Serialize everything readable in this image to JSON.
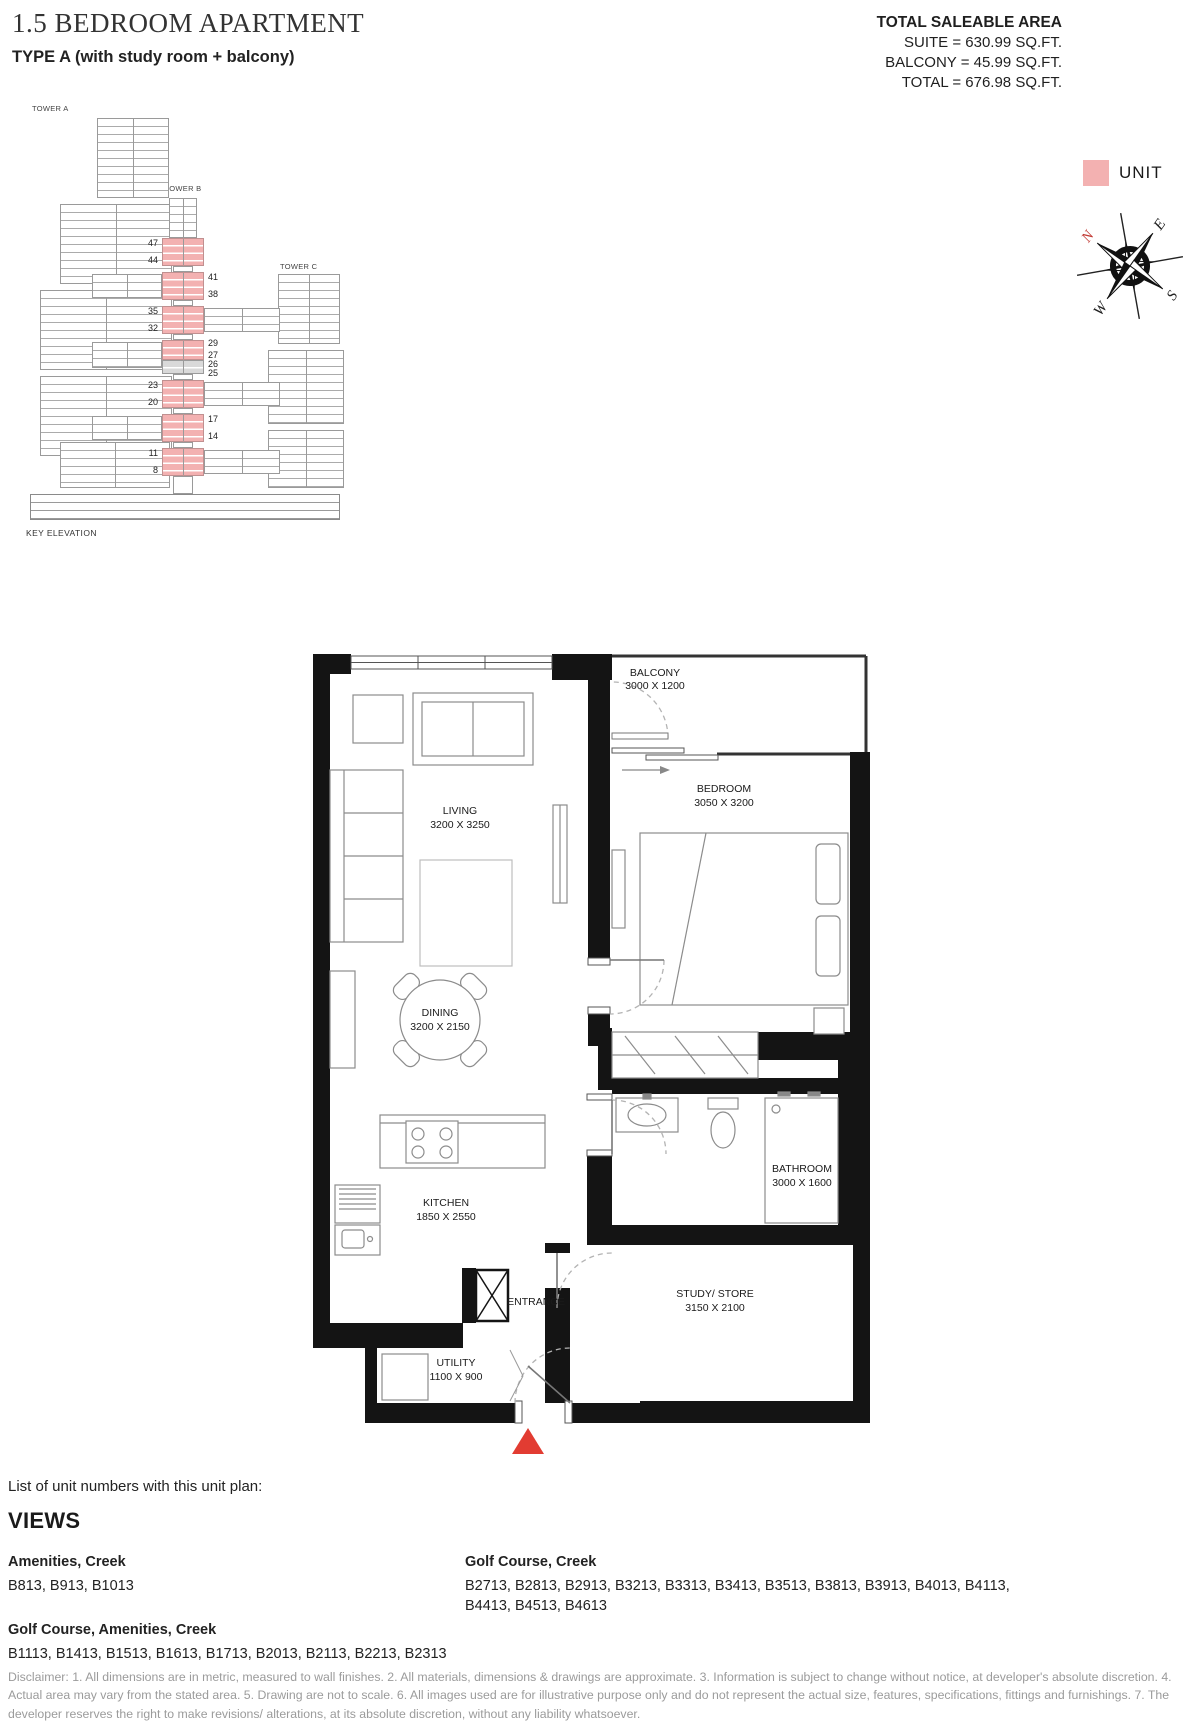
{
  "header": {
    "title": "1.5 BEDROOM APARTMENT",
    "subtitle": "TYPE A (with study room + balcony)"
  },
  "area_summary": {
    "heading": "TOTAL SALEABLE AREA",
    "lines": [
      "SUITE = 630.99 SQ.FT.",
      "BALCONY = 45.99 SQ.FT.",
      "TOTAL = 676.98 SQ.FT."
    ]
  },
  "elevation": {
    "towers": [
      "TOWER A",
      "TOWER B",
      "TOWER C"
    ],
    "caption": "KEY ELEVATION",
    "floors": [
      "47",
      "44",
      "41",
      "38",
      "35",
      "32",
      "29",
      "27",
      "26",
      "25",
      "23",
      "20",
      "17",
      "14",
      "11",
      "8"
    ],
    "highlight_color": "#f3b1b1"
  },
  "legend": {
    "unit_label": "UNIT",
    "unit_color": "#f3b1b1"
  },
  "compass": {
    "north": "N",
    "east": "E",
    "south": "S",
    "west": "W",
    "north_color": "#c23a34"
  },
  "floorplan": {
    "rooms": {
      "balcony": {
        "name": "BALCONY",
        "dims": "3000 X 1200"
      },
      "bedroom": {
        "name": "BEDROOM",
        "dims": "3050 X 3200"
      },
      "living": {
        "name": "LIVING",
        "dims": "3200 X 3250"
      },
      "dining": {
        "name": "DINING",
        "dims": "3200 X 2150"
      },
      "kitchen": {
        "name": "KITCHEN",
        "dims": "1850 X 2550"
      },
      "bathroom": {
        "name": "BATHROOM",
        "dims": "3000 X 1600"
      },
      "study": {
        "name": "STUDY/ STORE",
        "dims": "3150 X 2100"
      },
      "utility": {
        "name": "UTILITY",
        "dims": "1100 X 900"
      },
      "entrance": {
        "name": "ENTRANCE"
      }
    },
    "entrance_marker_color": "#e23c32"
  },
  "units_section": {
    "intro": "List of unit numbers with this unit plan:",
    "heading": "VIEWS",
    "groups": [
      {
        "view": "Amenities, Creek",
        "units": "B813, B913, B1013"
      },
      {
        "view": "Golf Course, Amenities, Creek",
        "units": "B1113, B1413, B1513, B1613, B1713, B2013, B2113, B2213, B2313"
      },
      {
        "view": "Golf Course, Creek",
        "units": "B2713, B2813, B2913, B3213, B3313, B3413, B3513, B3813, B3913, B4013, B4113, B4413, B4513, B4613"
      }
    ]
  },
  "disclaimer": "Disclaimer: 1. All dimensions are in metric, measured to wall finishes. 2. All materials, dimensions & drawings are approximate. 3. Information is subject to change without notice, at developer's absolute discretion. 4. Actual area may vary from the stated area. 5. Drawing are not to scale. 6. All images used are for illustrative purpose only and do not represent the actual size, features, specifications, fittings and furnishings. 7. The developer reserves the right to make revisions/ alterations, at its absolute discretion, without any liability whatsoever."
}
